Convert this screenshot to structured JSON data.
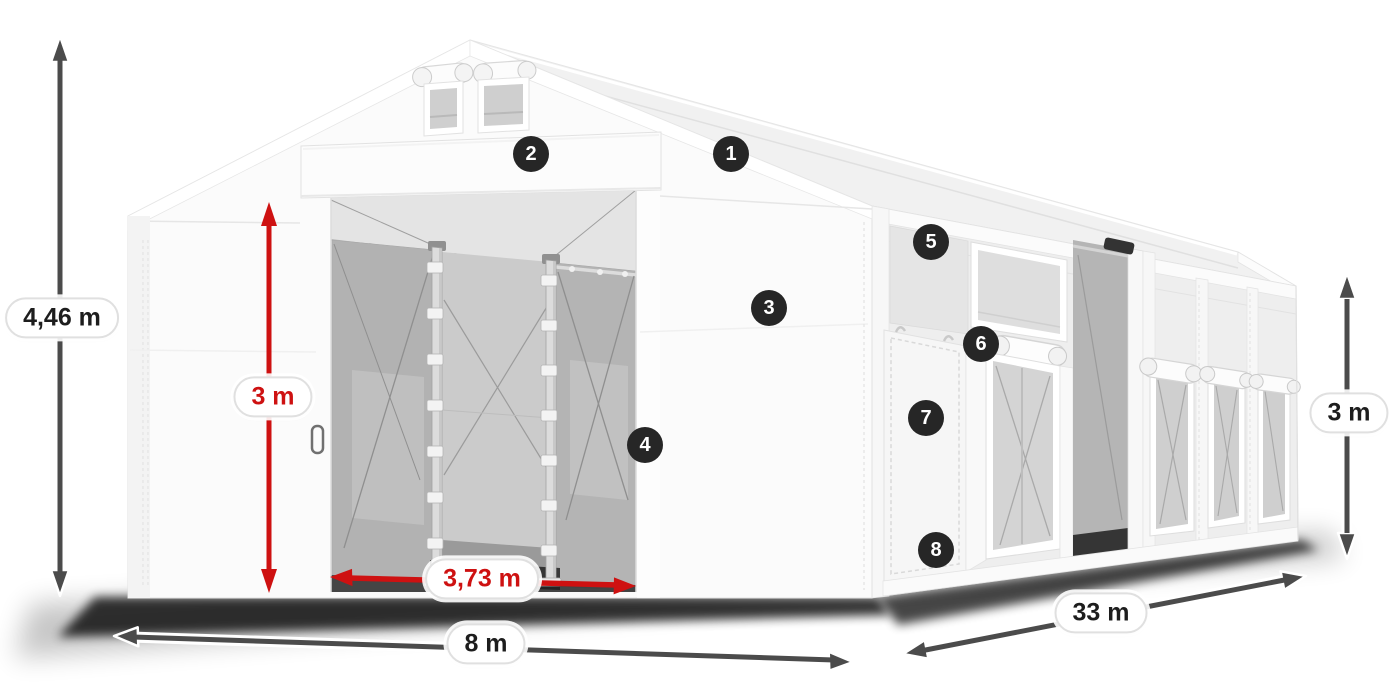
{
  "figure": {
    "description": "Dimensioned illustration of a white PVC storage tent with open front sliding gates, side door and mesh windows",
    "background_color": "#ffffff"
  },
  "annotations": {
    "dimensions": {
      "total_height": {
        "label": "4,46 m",
        "style": "dark"
      },
      "door_height": {
        "label": "3 m",
        "style": "red"
      },
      "door_width": {
        "label": "3,73 m",
        "style": "red"
      },
      "front_width": {
        "label": "8 m",
        "style": "dark"
      },
      "side_length": {
        "label": "33 m",
        "style": "dark"
      },
      "side_height": {
        "label": "3 m",
        "style": "dark"
      }
    },
    "markers": [
      "1",
      "2",
      "3",
      "4",
      "5",
      "6",
      "7",
      "8"
    ]
  },
  "colors": {
    "dimension_arrow_dark": "#4b4b4b",
    "dimension_arrow_red": "#ce1111",
    "marker_background": "#262626",
    "marker_text": "#ffffff",
    "pill_background": "#ffffff",
    "pill_border": "#e0e0e0",
    "tent_white": "#fbfbfb",
    "mesh_gray": "#b2b2b2"
  }
}
